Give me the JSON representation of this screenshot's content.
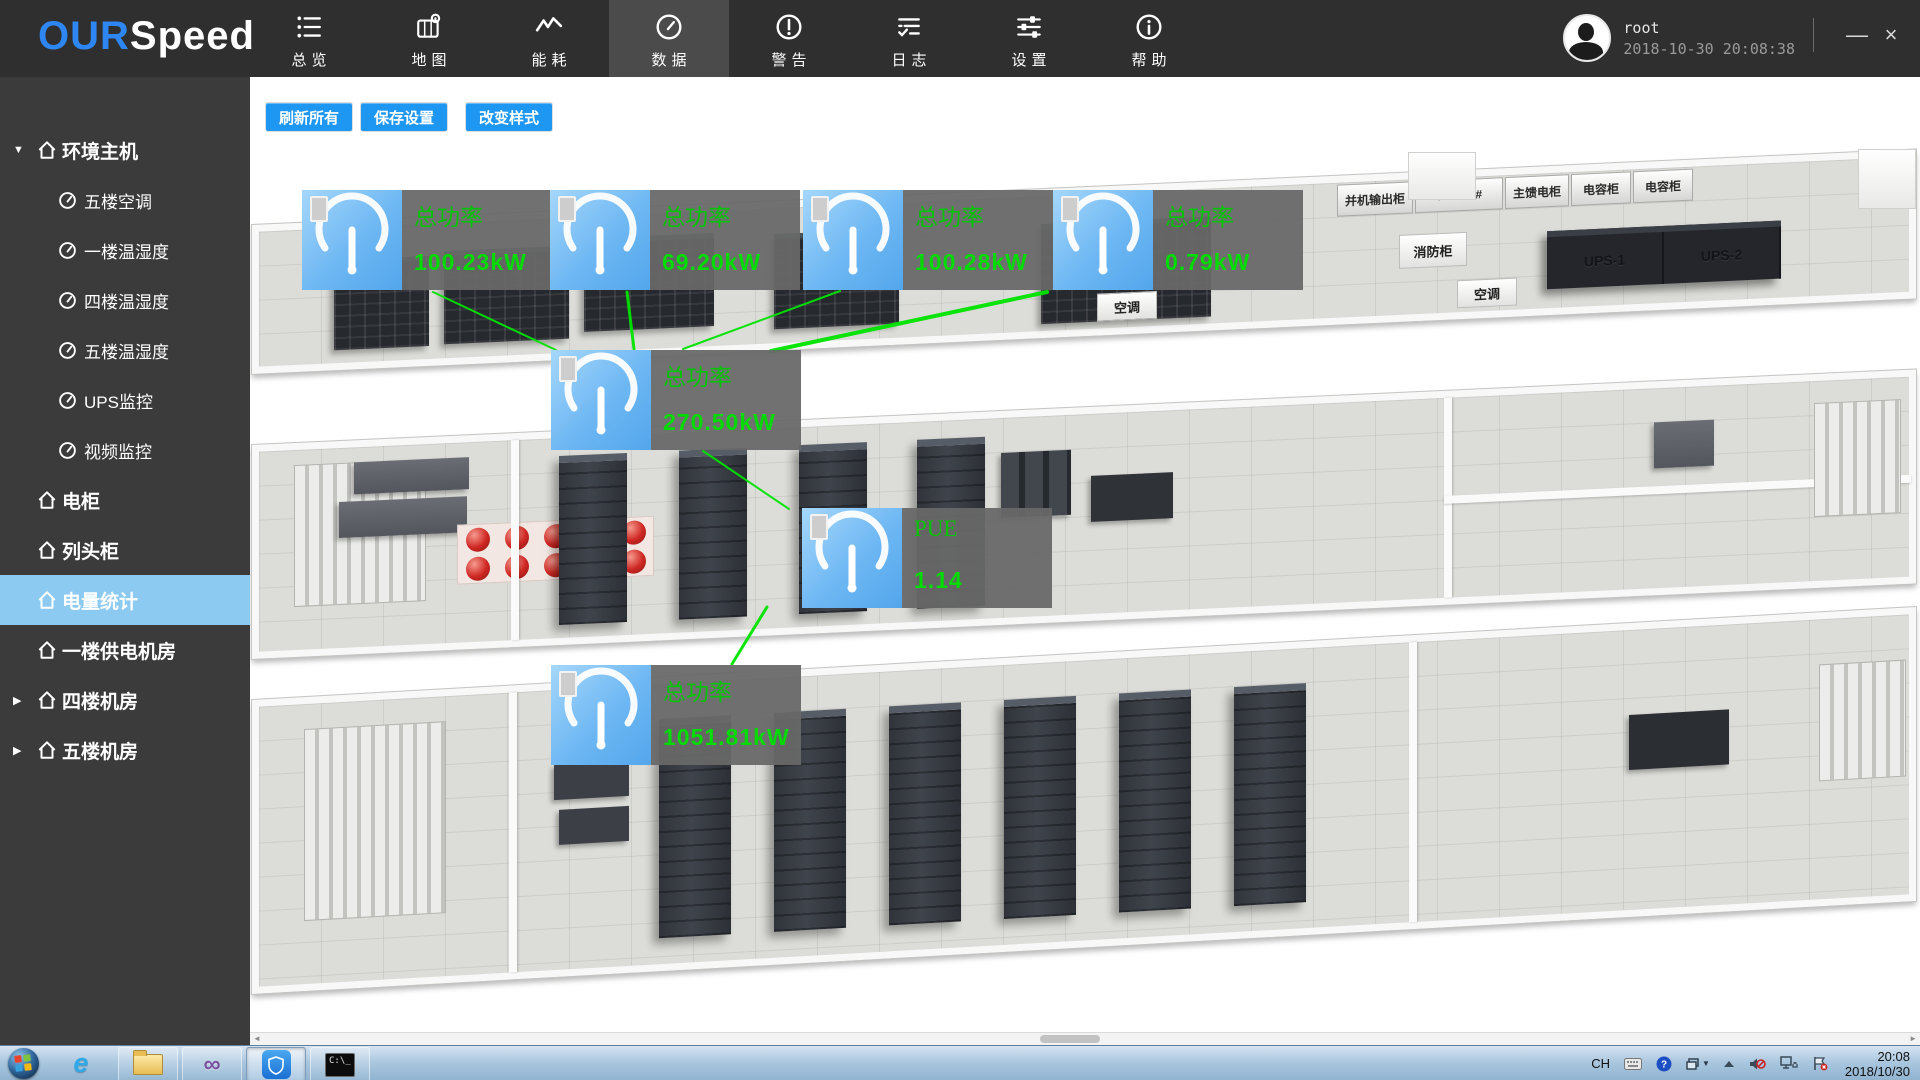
{
  "window": {
    "brand_our": "OUR",
    "brand_speed": "Speed",
    "minimize": "—",
    "close": "×",
    "user": {
      "name": "root",
      "datetime": "2018-10-30 20:08:38"
    }
  },
  "navbar": {
    "active": "数据",
    "items": [
      {
        "label": "总览",
        "icon": "overview-list-icon"
      },
      {
        "label": "地图",
        "icon": "map-icon"
      },
      {
        "label": "能耗",
        "icon": "energy-icon"
      },
      {
        "label": "数据",
        "icon": "data-gauge-icon"
      },
      {
        "label": "警告",
        "icon": "alert-icon"
      },
      {
        "label": "日志",
        "icon": "log-icon"
      },
      {
        "label": "设置",
        "icon": "settings-icon"
      },
      {
        "label": "帮助",
        "icon": "help-icon"
      }
    ]
  },
  "sidebar": {
    "items": [
      {
        "label": "环境主机",
        "level": 0,
        "expanded": true
      },
      {
        "label": "五楼空调",
        "level": 1
      },
      {
        "label": "一楼温湿度",
        "level": 1
      },
      {
        "label": "四楼温湿度",
        "level": 1
      },
      {
        "label": "五楼温湿度",
        "level": 1
      },
      {
        "label": "UPS监控",
        "level": 1
      },
      {
        "label": "视频监控",
        "level": 1
      },
      {
        "label": "电柜",
        "level": 0
      },
      {
        "label": "列头柜",
        "level": 0
      },
      {
        "label": "电量统计",
        "level": 0,
        "active": true
      },
      {
        "label": "一楼供电机房",
        "level": 0
      },
      {
        "label": "四楼机房",
        "level": 0,
        "collapsed": true
      },
      {
        "label": "五楼机房",
        "level": 0,
        "collapsed": true
      }
    ],
    "active_color": "#8ccaf2"
  },
  "toolbar": {
    "refresh": "刷新所有",
    "save": "保存设置",
    "style": "改变样式",
    "button_color": "#1e97f3"
  },
  "gauges": [
    {
      "label": "总功率",
      "value": "100.23kW"
    },
    {
      "label": "总功率",
      "value": "69.20kW"
    },
    {
      "label": "总功率",
      "value": "100.28kW"
    },
    {
      "label": "总功率",
      "value": "0.79kW"
    },
    {
      "label": "总功率",
      "value": "270.50kW"
    },
    {
      "label": "PUE",
      "value": "1.14"
    },
    {
      "label": "总功率",
      "value": "1051.81kW"
    }
  ],
  "gauge_colors": {
    "label_green": "#00c400",
    "value_green": "#00dc00",
    "line_green": "#00e400",
    "tile_blue": "#6db7f3"
  },
  "floorplan": {
    "cabinets": [
      "并机输出柜",
      "800A-1#",
      "主馈电柜",
      "电容柜",
      "电容柜"
    ],
    "fire_cabinet": "消防柜",
    "ups": [
      "UPS-1",
      "UPS-2"
    ],
    "ac": [
      "空调",
      "空调"
    ]
  },
  "taskbar": {
    "lang": "CH",
    "time": "20:08",
    "date": "2018/10/30",
    "apps": [
      "start",
      "internet-explorer",
      "file-explorer",
      "visual-studio",
      "monitoring-app",
      "command-prompt"
    ]
  }
}
